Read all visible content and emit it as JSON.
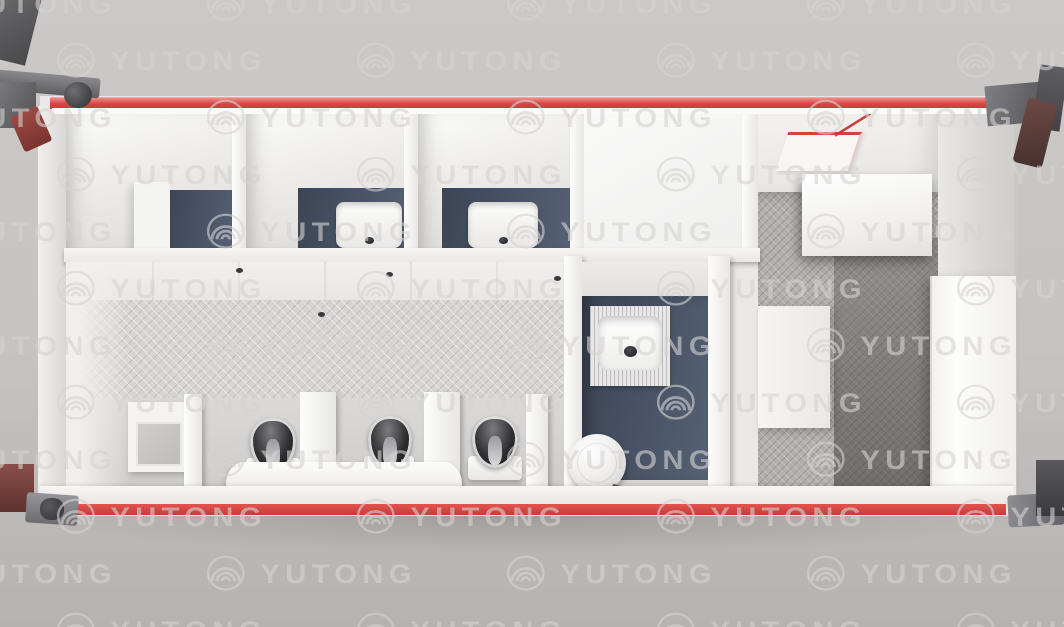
{
  "watermark": {
    "text": "YUTONG",
    "logo_icon": "concentric-arcs-brand-icon"
  },
  "colors": {
    "bg": "#c6c4c2",
    "trim_red": "#d84743",
    "wall_white": "#f5f4f3",
    "navy_tile": "#4a5466",
    "mosaic_light": "#d7d5d3",
    "mosaic_dark": "#b2b0ae",
    "shadow_dark": "#8e8c8a",
    "fixture_dark": "#26262a",
    "drain_red": "#c8403c",
    "watermark": "#d6d4d2"
  },
  "fixtures": {
    "top_row": [
      "storage-stall",
      "wash-stall",
      "wash-stall",
      "white-room"
    ],
    "main_room": [
      "vanity-mirror",
      "urinal",
      "urinal",
      "urinal",
      "bench",
      "privacy-divider"
    ],
    "wet_room": [
      "squat-toilet",
      "toilet",
      "floor-drain"
    ],
    "utility_area": [
      "ceiling-hatch",
      "cabinet",
      "partition-panel",
      "tall-cabinet"
    ]
  }
}
